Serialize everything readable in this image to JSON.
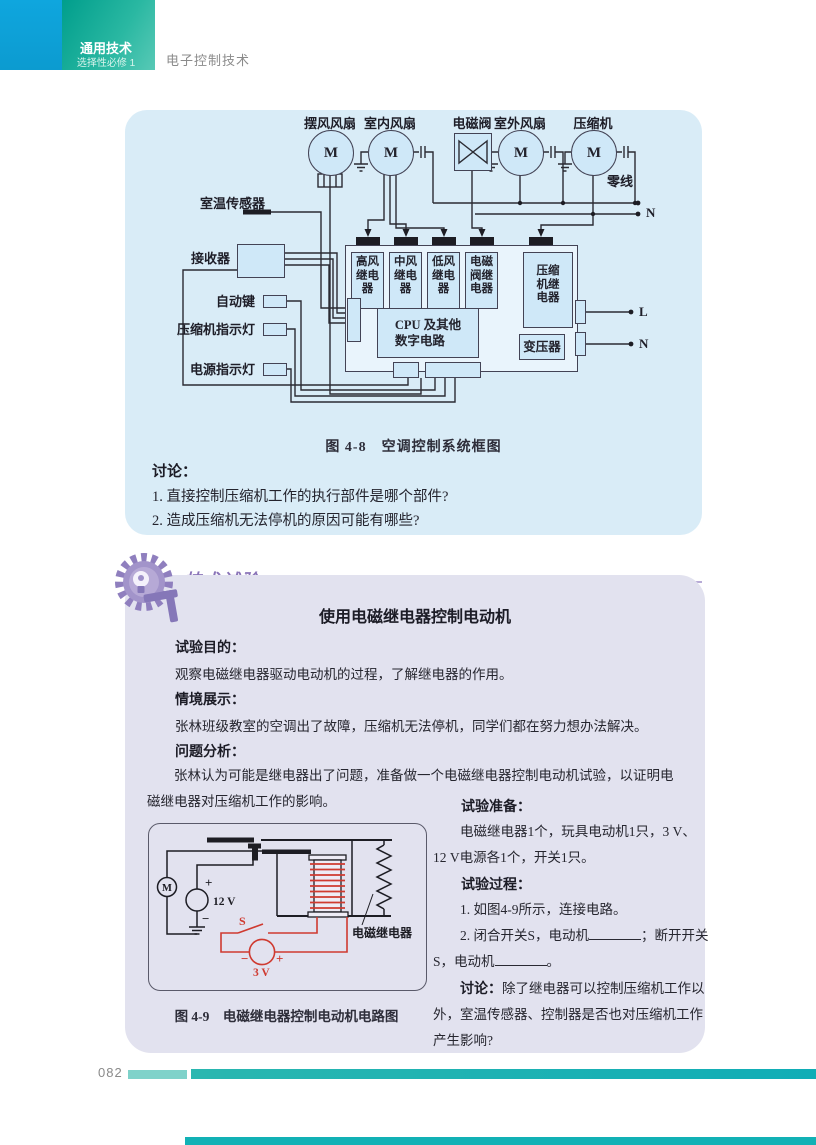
{
  "colors": {
    "brand_teal": "#009e8c",
    "header_blue": "#0fa6de",
    "accent_purple": "#8a74b8",
    "panel_blue": "#d9ecf7",
    "panel_purple": "#e2e2ef",
    "wire_red": "#cf3a30",
    "footer_teal": "#10adb6"
  },
  "header": {
    "series": "通用技术",
    "subtitle": "选择性必修 1",
    "chapter": "电子控制技术"
  },
  "fig48": {
    "components": [
      "摆风风扇",
      "室内风扇",
      "电磁阀",
      "室外风扇",
      "压缩机"
    ],
    "motor": "M",
    "neutral_label": "零线",
    "n_top": "N",
    "left_labels": [
      "室温传感器",
      "接收器",
      "自动键",
      "压缩机指示灯",
      "电源指示灯"
    ],
    "relays": [
      "高风继电器",
      "中风继电器",
      "低风继电器",
      "电磁阀继电器"
    ],
    "compressor_relay": "压缩机继电器",
    "cpu": "CPU 及其他\n数字电路",
    "transformer": "变压器",
    "l_label": "L",
    "n_label": "N",
    "caption": "图 4-8　空调控制系统框图"
  },
  "discussion": {
    "heading": "讨论：",
    "q1": "1. 直接控制压缩机工作的执行部件是哪个部件?",
    "q2": "2. 造成压缩机无法停机的原因可能有哪些?"
  },
  "experiment": {
    "badge": "技术试验",
    "title": "使用电磁继电器控制电动机",
    "purpose_heading": "试验目的：",
    "purpose": "观察电磁继电器驱动电动机的过程，了解继电器的作用。",
    "context_heading": "情境展示：",
    "context": "张林班级教室的空调出了故障，压缩机无法停机，同学们都在努力想办法解决。",
    "analysis_heading": "问题分析：",
    "analysis": "张林认为可能是继电器出了问题，准备做一个电磁继电器控制电动机试验，以证明电磁继电器对压缩机工作的影响。",
    "prep_heading": "试验准备：",
    "prep": "电磁继电器1个，玩具电动机1只，3 V、12 V电源各1个，开关1只。",
    "process_heading": "试验过程：",
    "step1": "1. 如图4-9所示，连接电路。",
    "step2a": "2. 闭合开关S，电动机",
    "step2b": "；断开开关S，电动机",
    "step2c": "。",
    "discuss_label": "讨论：",
    "discuss": "除了继电器可以控制压缩机工作以外，室温传感器、控制器是否也对压缩机工作产生影响?"
  },
  "fig49": {
    "motor": "M",
    "v12": "12 V",
    "v3": "3 V",
    "switch": "S",
    "plus": "+",
    "minus": "−",
    "relay_label": "电磁继电器",
    "caption": "图 4-9　电磁继电器控制电动机电路图"
  },
  "footer": {
    "page": "082"
  }
}
